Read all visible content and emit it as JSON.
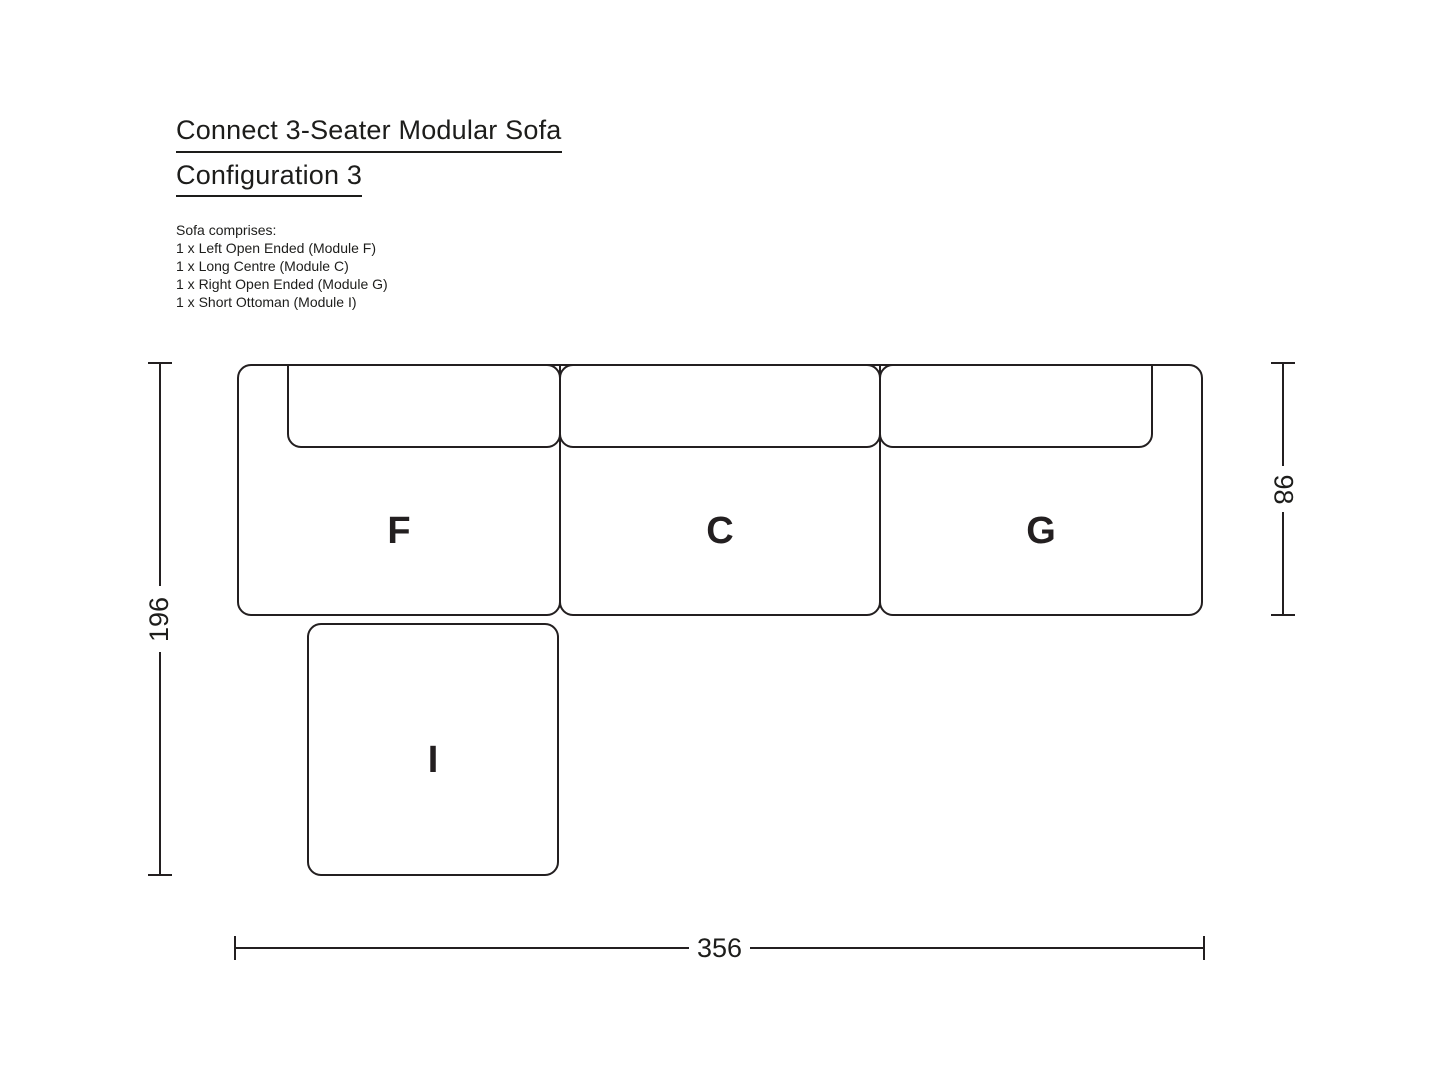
{
  "title": {
    "line1": "Connect 3-Seater Modular Sofa",
    "line2": "Configuration 3"
  },
  "comprises": {
    "heading": "Sofa comprises:",
    "items": [
      "1 x Left Open Ended (Module F)",
      "1 x Long Centre (Module C)",
      "1 x Right Open Ended (Module G)",
      "1 x Short Ottoman (Module I)"
    ]
  },
  "diagram": {
    "modules": [
      {
        "id": "F",
        "label": "F",
        "name": "Left Open Ended"
      },
      {
        "id": "C",
        "label": "C",
        "name": "Long Centre"
      },
      {
        "id": "G",
        "label": "G",
        "name": "Right Open Ended"
      },
      {
        "id": "I",
        "label": "I",
        "name": "Short Ottoman"
      }
    ],
    "dimensions": {
      "total_depth": "196",
      "seat_depth": "98",
      "total_width": "356"
    }
  },
  "colors": {
    "ink": "#231f20",
    "background": "#ffffff"
  }
}
